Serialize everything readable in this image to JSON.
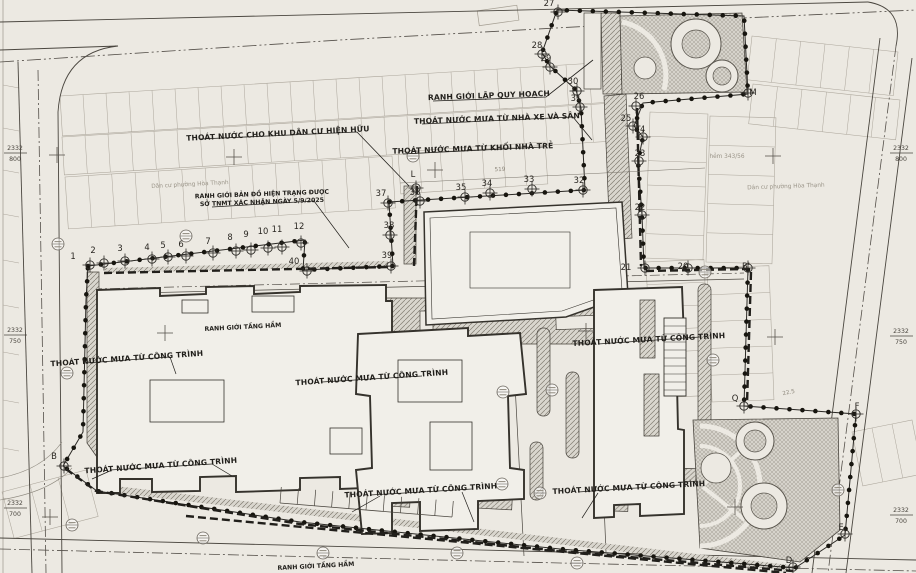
{
  "annotations": {
    "planning_boundary": "RANH GIỚI LẬP QUY HOẠCH",
    "drain_existing_residential": "THOÁT NƯỚC CHO KHU DÂN CƯ HIỆN HỮU",
    "drain_garage_yard": "THOÁT NƯỚC MƯA TỪ NHÀ XE VÀ SÂN",
    "drain_kindergarten": "THOÁT NƯỚC MƯA TỪ KHỐI NHÀ TRẺ",
    "survey_boundary_line1": "RANH GIỚI BẢN ĐỒ HIỆN TRẠNG ĐƯỢC",
    "survey_boundary_line2": "SỞ TNMT XÁC NHẬN NGÀY 5/9/2025",
    "drain_building": "THOÁT NƯỚC MƯA TỪ CÔNG TRÌNH",
    "basement_boundary": "RANH GIỚI TẦNG HẦM",
    "alley": "hẻm 343/56",
    "residential_area": "Dân cư phường Hòa Thạnh",
    "dim_519": "519",
    "dim_22_5": "22.5"
  },
  "grid": {
    "northing": "2332",
    "rows": [
      {
        "sub": "800"
      },
      {
        "sub": "750"
      },
      {
        "sub": "700"
      }
    ]
  },
  "boundary_point_labels": [
    "1",
    "2",
    "3",
    "4",
    "5",
    "6",
    "7",
    "8",
    "9",
    "10",
    "11",
    "12",
    "40",
    "39",
    "38",
    "37",
    "36",
    "35",
    "34",
    "33",
    "32",
    "31",
    "30",
    "29",
    "28",
    "27",
    "26",
    "M",
    "25",
    "24",
    "23",
    "22",
    "21",
    "20",
    "B'",
    "L",
    "Q",
    "F",
    "E",
    "D",
    "B"
  ],
  "colors": {
    "paper": "#ece9e2",
    "ink": "#35322c",
    "boundary_dot": "#17150f",
    "hatch_fill": "#d9d6ce",
    "parcel_line": "#aba59a"
  }
}
